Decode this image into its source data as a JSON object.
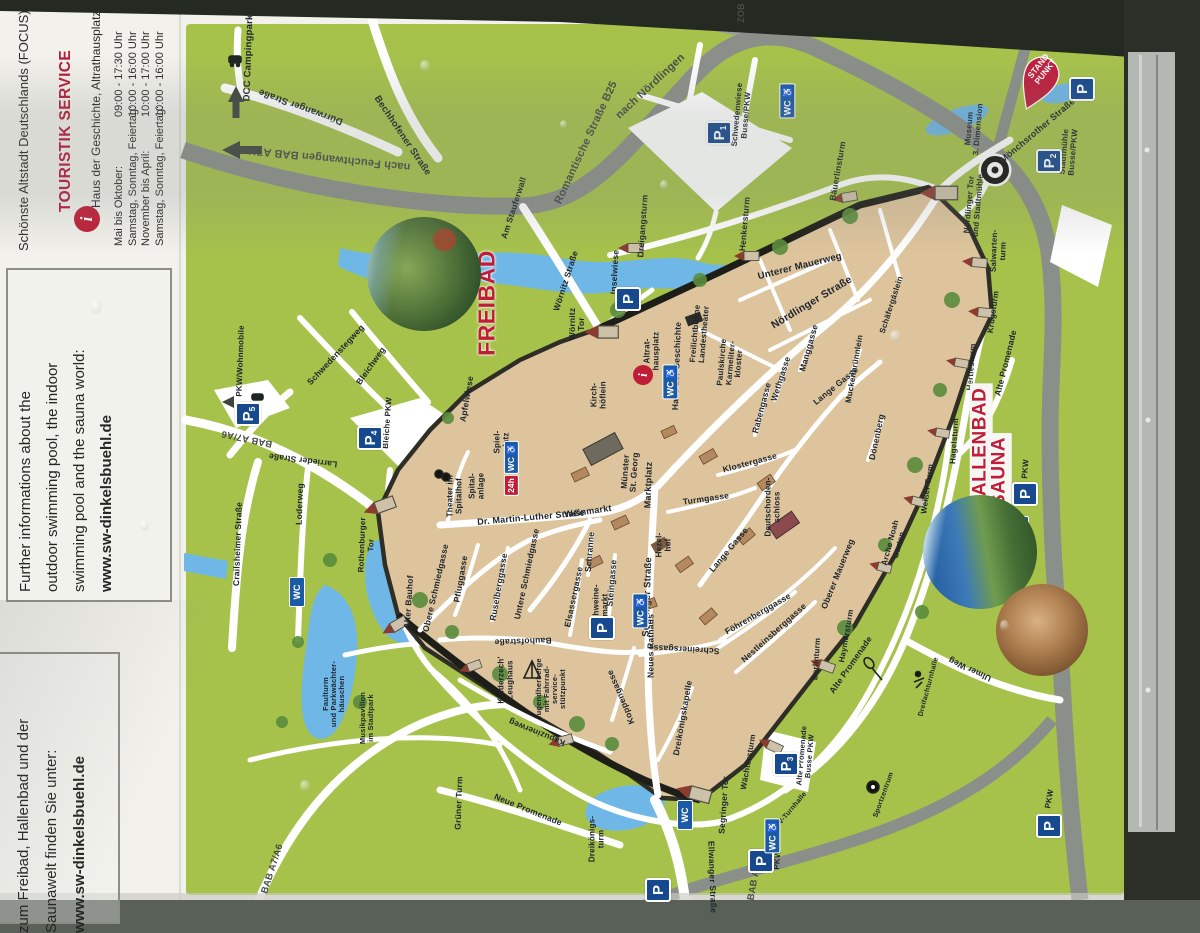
{
  "panel": {
    "title": "DINKELSBÜHL",
    "subtitle": "Schönste Altstadt Deutschlands (FOCUS)",
    "info_icon": "i",
    "touristik": "TOURISTIK SERVICE",
    "address": "Haus der Geschichte, Altrathausplatz 14",
    "hours": [
      {
        "label": "Mai bis Oktober:",
        "time": "09:00 - 17:30 Uhr"
      },
      {
        "label": "Samstag, Sonntag, Feiertag:",
        "time": "10:00 - 16:00 Uhr"
      },
      {
        "label": "November bis April:",
        "time": "10:00 - 17:00 Uhr"
      },
      {
        "label": "Samstag, Sonntag, Feiertag:",
        "time": "10:00 - 16:00 Uhr"
      }
    ],
    "english_box": {
      "lines": [
        "Further informations about the",
        "outdoor swimming pool, the indoor",
        "swimming pool and the sauna world:",
        "www.sw-dinkelsbuehl.de"
      ]
    },
    "german_box": {
      "lines": [
        "Weitere Informationen",
        "zum Freibad, Hallenbad und der",
        "Saunawelt finden Sie unter:",
        "www.sw-dinkelsbuehl.de"
      ]
    }
  },
  "map": {
    "pin_text": "STAND\nPUNKT",
    "colors": {
      "green": "#a6c24b",
      "oldtown": "#ddc49c",
      "water": "#6fb7e6",
      "ring_road": "#8b8f8a",
      "red": "#c01d37",
      "parking_blue": "#17498f"
    },
    "labels": [
      {
        "t": "DCC Campingpark",
        "x": 249,
        "y": 58,
        "r": -88,
        "f": 9.5
      },
      {
        "t": "Dürrwanger Straße",
        "x": 301,
        "y": 106,
        "r": -160,
        "f": 9.5
      },
      {
        "t": "nach Feuchtwangen BAB A7/A6",
        "x": 325,
        "y": 157,
        "r": -174,
        "f": 11,
        "c": "g"
      },
      {
        "t": "Bechhofener Straße",
        "x": 402,
        "y": 136,
        "r": 56,
        "f": 9.5
      },
      {
        "t": "Romantische Straße B25",
        "x": 587,
        "y": 143,
        "r": -65,
        "f": 11,
        "c": "g"
      },
      {
        "t": "nach Nördlingen",
        "x": 651,
        "y": 87,
        "r": -43,
        "f": 11,
        "c": "g"
      },
      {
        "t": "ZOB",
        "x": 742,
        "y": 13,
        "r": -90,
        "f": 9,
        "c": "g"
      },
      {
        "t": "Am Stauferwall",
        "x": 514,
        "y": 208,
        "r": -72,
        "f": 8.5
      },
      {
        "t": "Wörnitz Straße",
        "x": 566,
        "y": 281,
        "r": -72,
        "f": 8.5
      },
      {
        "t": "Wörnitz\nTor",
        "x": 577,
        "y": 324,
        "r": -90,
        "f": 8.5
      },
      {
        "t": "Inselwiese",
        "x": 615,
        "y": 272,
        "r": -87,
        "f": 8.5
      },
      {
        "t": "Dreigangsturm",
        "x": 643,
        "y": 226,
        "r": -86,
        "f": 8.5
      },
      {
        "t": "Henkersturm",
        "x": 745,
        "y": 224,
        "r": -85,
        "f": 8.5
      },
      {
        "t": "Bäuerlinsturm",
        "x": 838,
        "y": 171,
        "r": -80,
        "f": 8.5
      },
      {
        "t": "Unterer Mauerweg",
        "x": 800,
        "y": 267,
        "r": -14,
        "f": 9.5
      },
      {
        "t": "Nördlinger Straße",
        "x": 812,
        "y": 303,
        "r": -31,
        "f": 10.5
      },
      {
        "t": "Schäfergäslein",
        "x": 892,
        "y": 305,
        "r": -72,
        "f": 8
      },
      {
        "t": "Salwarten-\nturm",
        "x": 999,
        "y": 251,
        "r": -88,
        "f": 8
      },
      {
        "t": "Krugsturm",
        "x": 994,
        "y": 312,
        "r": -82,
        "f": 8
      },
      {
        "t": "Hertlesturm",
        "x": 972,
        "y": 367,
        "r": -86,
        "f": 8
      },
      {
        "t": "Hagelsturm",
        "x": 955,
        "y": 441,
        "r": -86,
        "f": 8
      },
      {
        "t": "Weißer Turm",
        "x": 928,
        "y": 489,
        "r": -82,
        "f": 8
      },
      {
        "t": "Arche Noah\nGarten",
        "x": 895,
        "y": 544,
        "r": -75,
        "f": 8
      },
      {
        "t": "Alte Promenade",
        "x": 1006,
        "y": 363,
        "r": -76,
        "f": 8.5
      },
      {
        "t": "Alte Promenade",
        "x": 851,
        "y": 665,
        "r": -55,
        "f": 8.5
      },
      {
        "t": "Museum\n3. Dimension",
        "x": 974,
        "y": 129,
        "r": -85,
        "f": 8
      },
      {
        "t": "Nördlinger Tor\nund Stadtmühle",
        "x": 974,
        "y": 205,
        "r": -85,
        "f": 8
      },
      {
        "t": "Mönchsrother Straße",
        "x": 1038,
        "y": 131,
        "r": -40,
        "f": 9
      },
      {
        "t": "Stadtmühle\nBusse/PKW",
        "x": 1069,
        "y": 152,
        "r": -85,
        "f": 8
      },
      {
        "t": "Schwedenwiese\nBusse/PKW",
        "x": 742,
        "y": 115,
        "r": -85,
        "f": 8
      },
      {
        "t": "Haus der Geschichte",
        "x": 677,
        "y": 366,
        "r": -88,
        "f": 8.5
      },
      {
        "t": "Altrat-\nhausplatz",
        "x": 652,
        "y": 351,
        "r": -90,
        "f": 8
      },
      {
        "t": "Kirch-\nhöflein",
        "x": 599,
        "y": 395,
        "r": -90,
        "f": 8
      },
      {
        "t": "Freilichtbühne\nLandestheater",
        "x": 700,
        "y": 334,
        "r": -85,
        "f": 8
      },
      {
        "t": "Paulskirche\nKarmeliter-\nkloster",
        "x": 731,
        "y": 363,
        "r": -85,
        "f": 8
      },
      {
        "t": "Rabengasse",
        "x": 762,
        "y": 408,
        "r": -75,
        "f": 8.5
      },
      {
        "t": "Wethgasse",
        "x": 781,
        "y": 379,
        "r": -72,
        "f": 8.5
      },
      {
        "t": "Manggasse",
        "x": 809,
        "y": 348,
        "r": -74,
        "f": 8.5
      },
      {
        "t": "Lange Gasse",
        "x": 836,
        "y": 386,
        "r": -39,
        "f": 8.5
      },
      {
        "t": "Muckenbrünnlein",
        "x": 855,
        "y": 369,
        "r": -80,
        "f": 8
      },
      {
        "t": "Dönenberg",
        "x": 877,
        "y": 437,
        "r": -78,
        "f": 8.5
      },
      {
        "t": "Klostergasse",
        "x": 750,
        "y": 463,
        "r": -15,
        "f": 8.5
      },
      {
        "t": "Turmgasse",
        "x": 706,
        "y": 499,
        "r": -8,
        "f": 8.5
      },
      {
        "t": "Lange Gasse",
        "x": 729,
        "y": 550,
        "r": -50,
        "f": 8.5
      },
      {
        "t": "Deutschorden-\nschloss",
        "x": 773,
        "y": 507,
        "r": -90,
        "f": 8
      },
      {
        "t": "Oberer Mauerweg",
        "x": 838,
        "y": 574,
        "r": -68,
        "f": 8.5
      },
      {
        "t": "Münster\nSt. Georg",
        "x": 630,
        "y": 472,
        "r": -86,
        "f": 8.5
      },
      {
        "t": "Marktplatz",
        "x": 649,
        "y": 485,
        "r": -88,
        "f": 9
      },
      {
        "t": "Weinmarkt",
        "x": 588,
        "y": 512,
        "r": -8,
        "f": 9
      },
      {
        "t": "Dr. Martin-Luther Straße",
        "x": 531,
        "y": 518,
        "r": -5,
        "f": 9
      },
      {
        "t": "Schranne",
        "x": 590,
        "y": 552,
        "r": -85,
        "f": 8.5
      },
      {
        "t": "Steingasse",
        "x": 612,
        "y": 583,
        "r": -85,
        "f": 8.5
      },
      {
        "t": "Schweine-\nmarkt",
        "x": 601,
        "y": 605,
        "r": -90,
        "f": 8
      },
      {
        "t": "Hezel-\nhof",
        "x": 664,
        "y": 545,
        "r": -90,
        "f": 8
      },
      {
        "t": "Elsassergasse",
        "x": 574,
        "y": 597,
        "r": -78,
        "f": 8.5
      },
      {
        "t": "Untere Schmiedgasse",
        "x": 527,
        "y": 574,
        "r": -78,
        "f": 8.5
      },
      {
        "t": "Ruselberggasse",
        "x": 499,
        "y": 587,
        "r": -80,
        "f": 8.5
      },
      {
        "t": "Pfluggasse",
        "x": 461,
        "y": 579,
        "r": -80,
        "f": 8.5
      },
      {
        "t": "Obere Schmiedgasse",
        "x": 436,
        "y": 588,
        "r": -77,
        "f": 8.5
      },
      {
        "t": "Alter Bauhof",
        "x": 409,
        "y": 602,
        "r": -86,
        "f": 8.5
      },
      {
        "t": "Bauhofstraße",
        "x": 523,
        "y": 641,
        "r": 178,
        "f": 8.5
      },
      {
        "t": "Segringer Straße",
        "x": 648,
        "y": 597,
        "r": -88,
        "f": 9.5
      },
      {
        "t": "Neues Rathaus",
        "x": 651,
        "y": 646,
        "r": -90,
        "f": 8.5
      },
      {
        "t": "Schreinersgasse",
        "x": 684,
        "y": 649,
        "r": -177,
        "f": 8.5
      },
      {
        "t": "Koppengasse",
        "x": 621,
        "y": 697,
        "r": -113,
        "f": 8.5
      },
      {
        "t": "Dreikönigskapelle",
        "x": 683,
        "y": 718,
        "r": -80,
        "f": 8.5
      },
      {
        "t": "Dreikönigs-\nturm",
        "x": 597,
        "y": 839,
        "r": -90,
        "f": 8
      },
      {
        "t": "Segringer Tor",
        "x": 724,
        "y": 805,
        "r": -86,
        "f": 8.5
      },
      {
        "t": "Wächtersturm",
        "x": 749,
        "y": 762,
        "r": -80,
        "f": 8
      },
      {
        "t": "Föhrenberggasse",
        "x": 758,
        "y": 614,
        "r": -30,
        "f": 8.5
      },
      {
        "t": "Nestleinsberggasse",
        "x": 774,
        "y": 633,
        "r": -42,
        "f": 8.5
      },
      {
        "t": "Kapuzinerweg",
        "x": 537,
        "y": 732,
        "r": -158,
        "f": 8.5
      },
      {
        "t": "Jugendherberge\nmit Fahrrad-\nservice-\nstützpunkt",
        "x": 551,
        "y": 689,
        "r": -90,
        "f": 7.5
      },
      {
        "t": "Kinderzech'\nZeughaus",
        "x": 506,
        "y": 680,
        "r": -90,
        "f": 8
      },
      {
        "t": "Faulturm\nund Parkwächter-\nhäuschen",
        "x": 334,
        "y": 694,
        "r": -90,
        "f": 7.5
      },
      {
        "t": "Musikpavillon\nim Stadtpark",
        "x": 367,
        "y": 718,
        "r": -90,
        "f": 7.5
      },
      {
        "t": "Grüner Turm",
        "x": 459,
        "y": 803,
        "r": -88,
        "f": 8.5
      },
      {
        "t": "Neue Promenade",
        "x": 528,
        "y": 810,
        "r": 22,
        "f": 8.5
      },
      {
        "t": "Rothenburger\nTor",
        "x": 367,
        "y": 545,
        "r": -88,
        "f": 8
      },
      {
        "t": "Crailsheimer Straße",
        "x": 238,
        "y": 544,
        "r": -88,
        "f": 8.5
      },
      {
        "t": "Loderweg",
        "x": 300,
        "y": 504,
        "r": -88,
        "f": 8.5
      },
      {
        "t": "Larrieder Straße",
        "x": 303,
        "y": 460,
        "r": -173,
        "f": 8.5
      },
      {
        "t": "BAB A7/A6",
        "x": 247,
        "y": 438,
        "r": -168,
        "f": 9.5,
        "c": "g"
      },
      {
        "t": "Schwedenstegweg",
        "x": 336,
        "y": 355,
        "r": -47,
        "f": 8.5
      },
      {
        "t": "Bleichweg",
        "x": 371,
        "y": 366,
        "r": -55,
        "f": 8.5
      },
      {
        "t": "Bleiche PKW",
        "x": 388,
        "y": 423,
        "r": -86,
        "f": 8
      },
      {
        "t": "PKW/Wohnmobile",
        "x": 241,
        "y": 361,
        "r": -88,
        "f": 8
      },
      {
        "t": "Apfelwiese",
        "x": 467,
        "y": 399,
        "r": -80,
        "f": 8.5
      },
      {
        "t": "Spiel-\nplatz",
        "x": 502,
        "y": 442,
        "r": -90,
        "f": 8
      },
      {
        "t": "Theater im\nSpitalhof",
        "x": 455,
        "y": 496,
        "r": -90,
        "f": 8
      },
      {
        "t": "Spital-\nanlage",
        "x": 477,
        "y": 486,
        "r": -90,
        "f": 8
      },
      {
        "t": "BAB A7/A6",
        "x": 273,
        "y": 869,
        "r": -72,
        "f": 9.5,
        "c": "g"
      },
      {
        "t": "BAB A7/A6",
        "x": 756,
        "y": 875,
        "r": -80,
        "f": 9.5,
        "c": "g"
      },
      {
        "t": "Ellwanger Straße",
        "x": 712,
        "y": 877,
        "r": 88,
        "f": 8.5
      },
      {
        "t": "Ulmer Weg",
        "x": 970,
        "y": 669,
        "r": -155,
        "f": 8.5
      },
      {
        "t": "Berlinturm",
        "x": 817,
        "y": 659,
        "r": -86,
        "f": 8
      },
      {
        "t": "Haymarsturm",
        "x": 847,
        "y": 636,
        "r": -80,
        "f": 8
      },
      {
        "t": "TSV-Turnhalle",
        "x": 790,
        "y": 812,
        "r": -50,
        "f": 7
      },
      {
        "t": "Sportzentrum",
        "x": 884,
        "y": 795,
        "r": -70,
        "f": 7
      },
      {
        "t": "Dreifachturnhalle",
        "x": 929,
        "y": 687,
        "r": -75,
        "f": 7
      },
      {
        "t": "PKW",
        "x": 1026,
        "y": 469,
        "r": -85,
        "f": 8
      },
      {
        "t": "PKW",
        "x": 1050,
        "y": 799,
        "r": -80,
        "f": 8
      },
      {
        "t": "PKW",
        "x": 778,
        "y": 860,
        "r": -85,
        "f": 8
      },
      {
        "t": "Alte Promenade\nBusse PKW",
        "x": 806,
        "y": 756,
        "r": -85,
        "f": 7.5
      },
      {
        "t": "FREIBAD",
        "x": 487,
        "y": 303,
        "r": -90,
        "f": 23,
        "c": "r"
      },
      {
        "t": "HALLENBAD",
        "x": 981,
        "y": 449,
        "r": -90,
        "f": 19,
        "c": "r bg"
      },
      {
        "t": "SAUNA",
        "x": 1000,
        "y": 472,
        "r": -90,
        "f": 19,
        "c": "r bg"
      }
    ],
    "badges": [
      {
        "x": 718,
        "y": 131,
        "k": "p",
        "n": "1"
      },
      {
        "x": 1048,
        "y": 159,
        "k": "p",
        "n": "2"
      },
      {
        "x": 785,
        "y": 762,
        "k": "p",
        "n": "3"
      },
      {
        "x": 369,
        "y": 436,
        "k": "p",
        "n": "4"
      },
      {
        "x": 247,
        "y": 412,
        "k": "p",
        "n": "5"
      },
      {
        "x": 1024,
        "y": 492,
        "k": "p"
      },
      {
        "x": 1048,
        "y": 824,
        "k": "p"
      },
      {
        "x": 760,
        "y": 859,
        "k": "p"
      },
      {
        "x": 657,
        "y": 888,
        "k": "p"
      },
      {
        "x": 627,
        "y": 297,
        "k": "p"
      },
      {
        "x": 601,
        "y": 626,
        "k": "p"
      },
      {
        "x": 1081,
        "y": 87,
        "k": "p"
      },
      {
        "x": 783,
        "y": 101,
        "k": "wc",
        "acc": true
      },
      {
        "x": 666,
        "y": 382,
        "k": "wc",
        "acc": true
      },
      {
        "x": 295,
        "y": 592,
        "k": "wc"
      },
      {
        "x": 636,
        "y": 611,
        "k": "wc",
        "acc": true
      },
      {
        "x": 683,
        "y": 815,
        "k": "wc"
      },
      {
        "x": 768,
        "y": 836,
        "k": "wc",
        "acc": true
      },
      {
        "x": 1019,
        "y": 531,
        "k": "wc"
      },
      {
        "x": 500,
        "y": 469,
        "k": "wc24"
      },
      {
        "x": 643,
        "y": 375,
        "k": "i"
      }
    ],
    "photos": [
      {
        "x": 424,
        "y": 274,
        "rad": 57,
        "k": "freibad"
      },
      {
        "x": 980,
        "y": 552,
        "rad": 57,
        "k": "hallenbad"
      },
      {
        "x": 1042,
        "y": 630,
        "rad": 46,
        "k": "sauna"
      }
    ]
  }
}
